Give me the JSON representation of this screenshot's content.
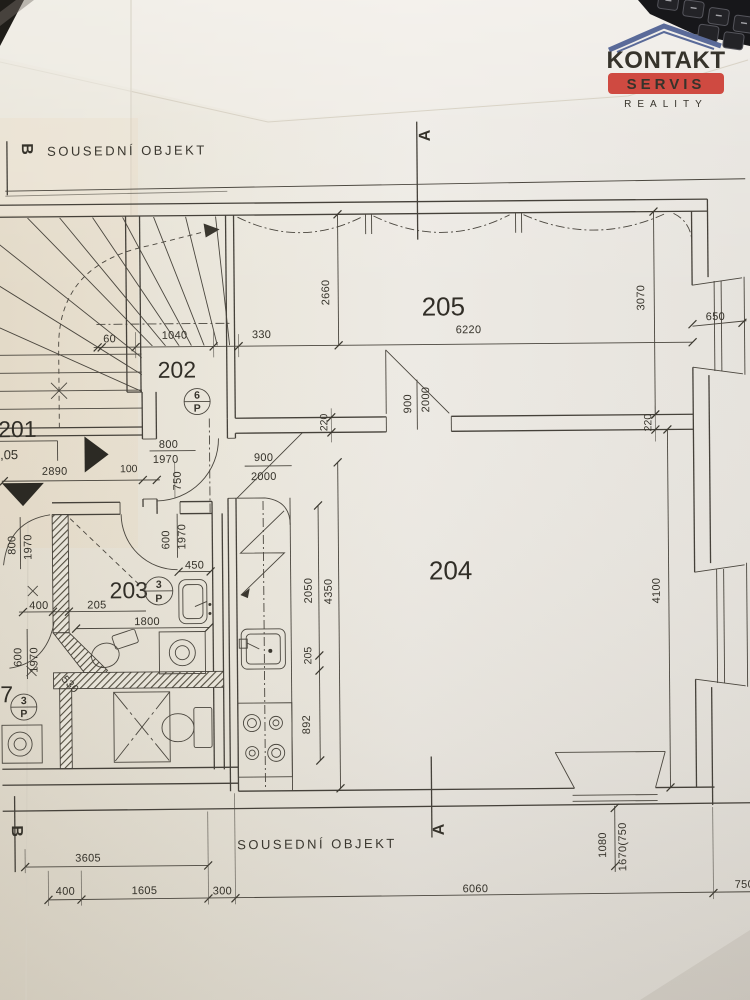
{
  "logo": {
    "title": "KONTAKT",
    "subtitle": "SERVIS",
    "tagline": "REALITY",
    "accent_blue": "#5a6a99",
    "accent_red": "#cf4a41"
  },
  "neighbor": {
    "top": "SOUSEDNÍ OBJEKT",
    "bottom": "SOUSEDNÍ OBJEKT"
  },
  "markers": {
    "section_a_top": "A",
    "section_a_bottom": "A",
    "section_b_top": "B",
    "section_b_bottom": "B"
  },
  "rooms": {
    "r201": "201",
    "r202": "202",
    "r203": "203",
    "r204": "204",
    "r205": "205",
    "r207": "7"
  },
  "elevation": "14,05",
  "symbols": {
    "s1_num": "6",
    "s1_letter": "P",
    "s2_num": "3",
    "s2_letter": "P",
    "s3_num": "3",
    "s3_letter": "P"
  },
  "dims": {
    "top_60": "60",
    "top_1040": "1040",
    "top_330": "330",
    "top_6220": "6220",
    "v_2660": "2660",
    "v_3070": "3070",
    "win_650": "650",
    "door205_900": "900",
    "door205_2000": "2000",
    "wall_220_l": "220",
    "wall_220_r": "220",
    "door202_800": "800",
    "door202_1970": "1970",
    "v_750": "750",
    "door204_900": "900",
    "door204_2000": "2000",
    "d_2890": "2890",
    "d_100": "100",
    "doorL_800": "800",
    "doorL_1970": "1970",
    "d_400": "400",
    "d_205": "205",
    "door203_600": "600",
    "door203_1970": "1970",
    "d_450": "450",
    "d_530": "530",
    "d_1800": "1800",
    "doorW_600": "600",
    "doorW_1970": "1970",
    "k_2050": "2050",
    "k_4350": "4350",
    "k_205": "205",
    "k_892": "892",
    "v_4100": "4100",
    "b_3605": "3605",
    "b_400": "400",
    "b_1605": "1605",
    "b_300": "300",
    "b_6060": "6060",
    "b_750": "750",
    "w_1080": "1080",
    "w_1670": "1670(750"
  }
}
